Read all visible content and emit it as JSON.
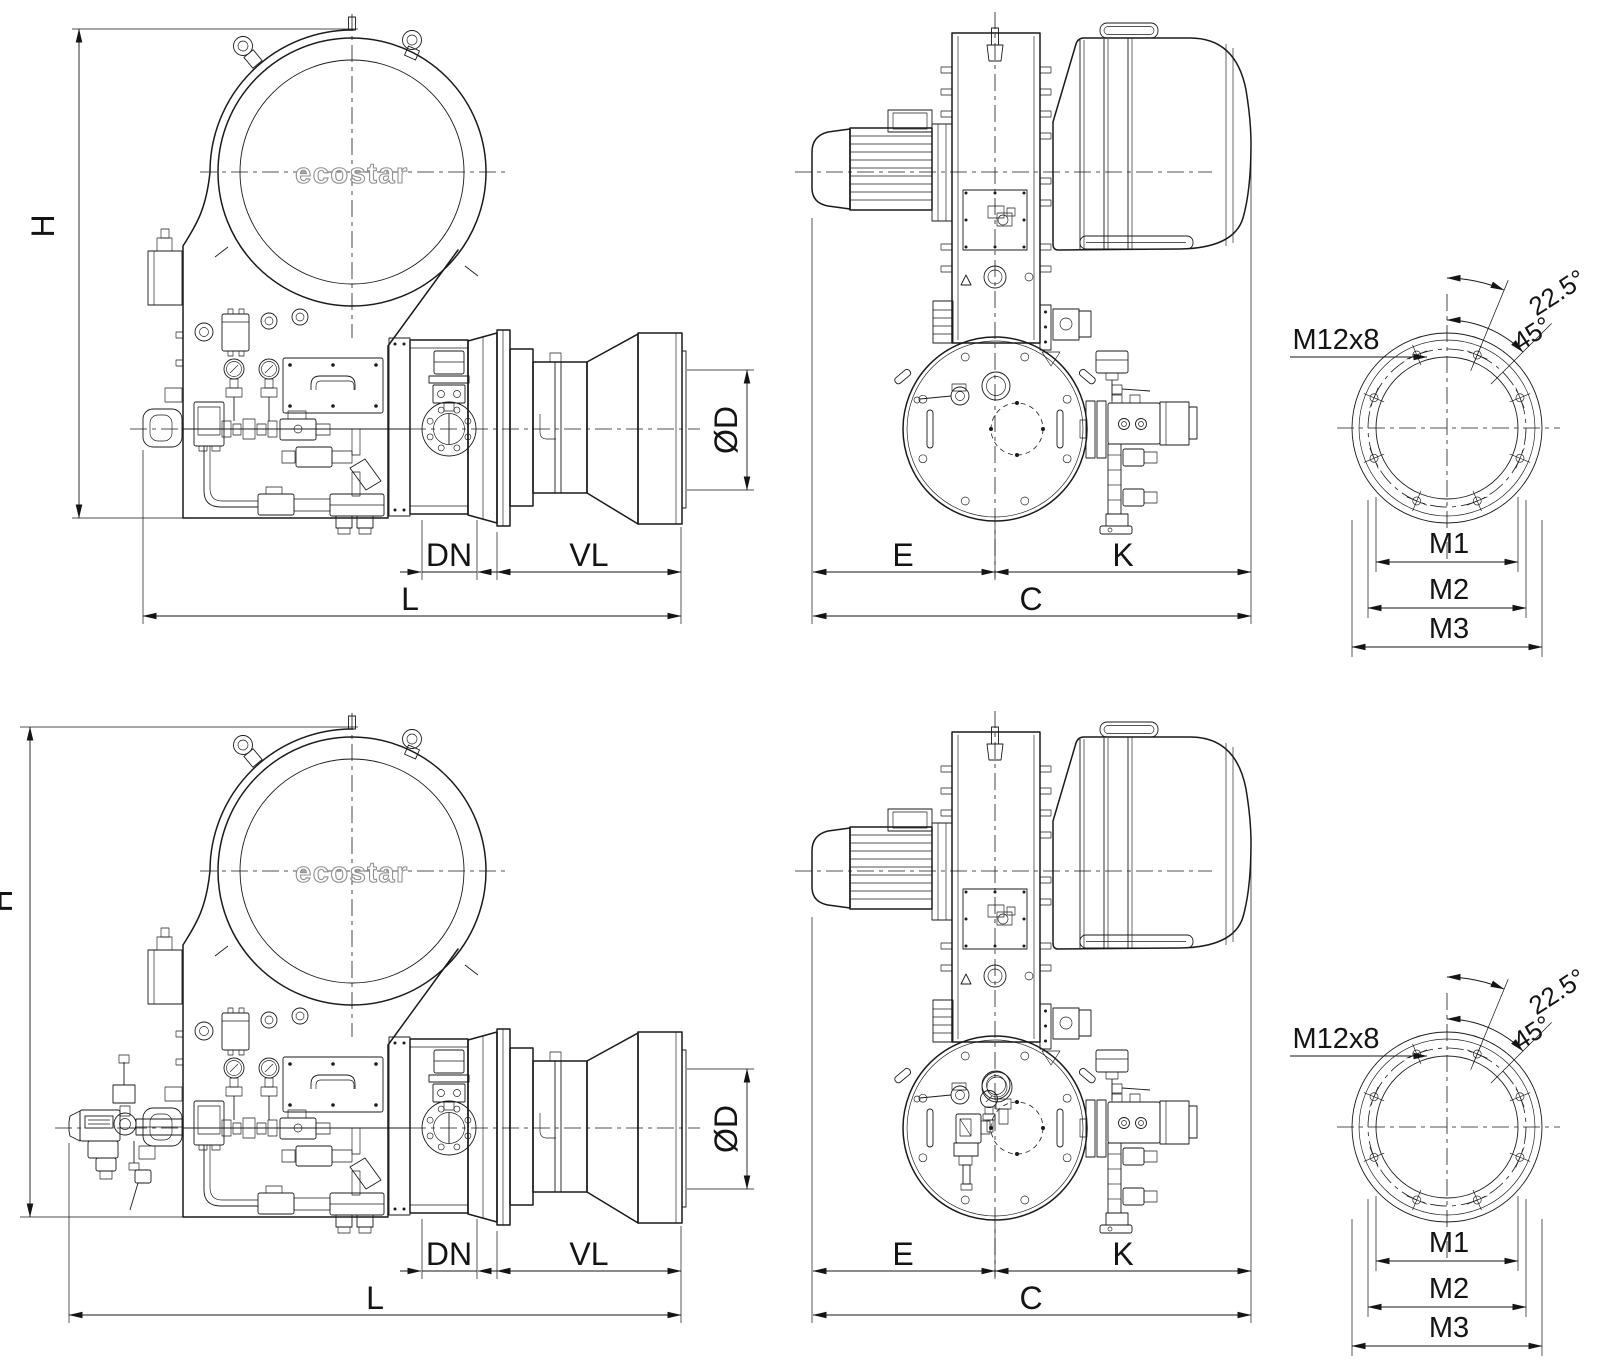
{
  "brand": {
    "logo": "ecostar"
  },
  "views": {
    "side": {
      "labels": {
        "h": "H",
        "dn": "DN",
        "vl": "VL",
        "l": "L",
        "od": "ØD"
      }
    },
    "front": {
      "labels": {
        "e": "E",
        "k": "K",
        "c": "C"
      }
    },
    "flange": {
      "labels": {
        "bolts": "M12x8",
        "a1": "22.5°",
        "a2": "45°",
        "m1": "M1",
        "m2": "M2",
        "m3": "M3"
      }
    }
  },
  "colors": {
    "line": "#1a1a1a",
    "dimension": "#141414",
    "logo_outline": "#909090",
    "background": "#ffffff"
  }
}
